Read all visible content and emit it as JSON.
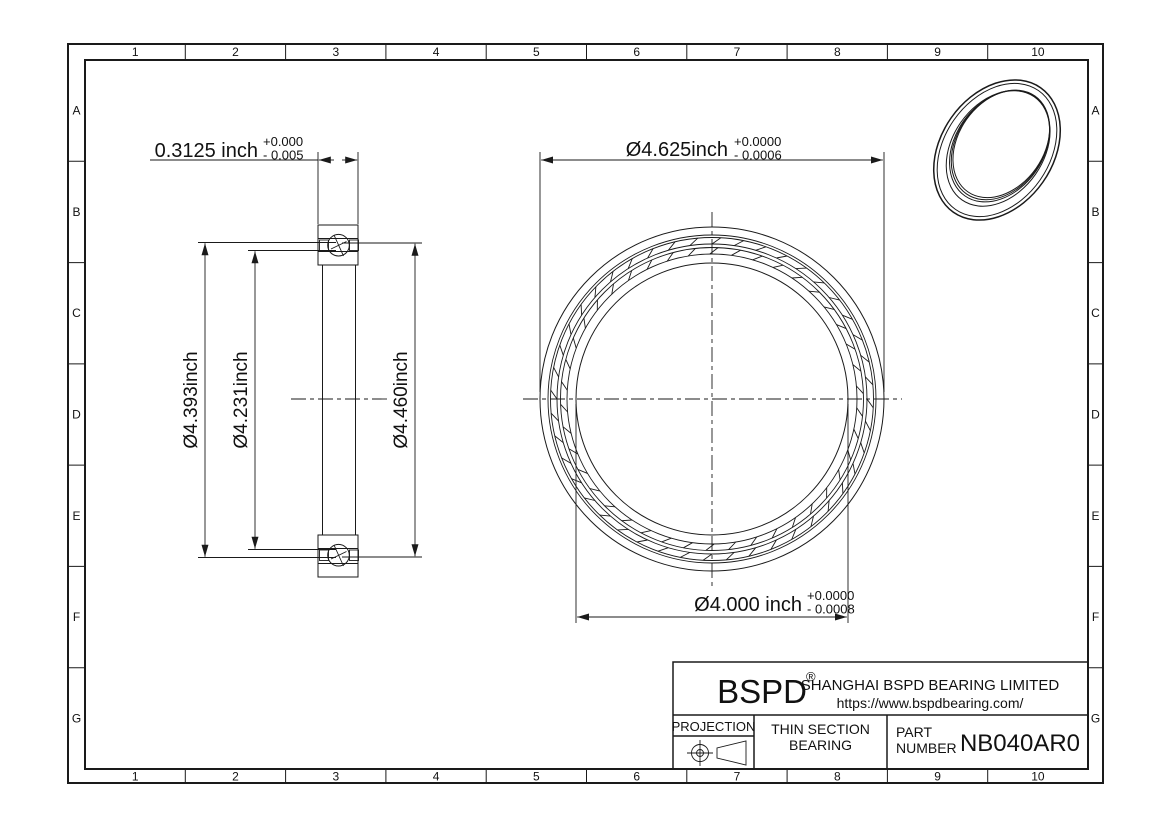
{
  "frame": {
    "cols": [
      "1",
      "2",
      "3",
      "4",
      "5",
      "6",
      "7",
      "8",
      "9",
      "10"
    ],
    "rows": [
      "A",
      "B",
      "C",
      "D",
      "E",
      "F",
      "G"
    ]
  },
  "dims": {
    "width": {
      "value": "0.3125 inch",
      "tol_plus": "+0.000",
      "tol_minus": "- 0.005"
    },
    "outer_dia": {
      "value": "Ø4.625inch",
      "tol_plus": "+0.0000",
      "tol_minus": "- 0.0006"
    },
    "bore_dia": {
      "value": "Ø4.000 inch",
      "tol_plus": "+0.0000",
      "tol_minus": "- 0.0008"
    },
    "left_outer": "Ø4.393inch",
    "left_inner": "Ø4.231inch",
    "right_outer": "Ø4.460inch"
  },
  "title_block": {
    "brand": "BSPD",
    "registered": "®",
    "company": "SHANGHAI BSPD BEARING LIMITED",
    "website": "https://www.bspdbearing.com/",
    "projection_label": "PROJECTION",
    "product_line1": "THIN SECTION",
    "product_line2": "BEARING",
    "part_label_line1": "PART",
    "part_label_line2": "NUMBER",
    "part_number": "NB040AR0"
  }
}
